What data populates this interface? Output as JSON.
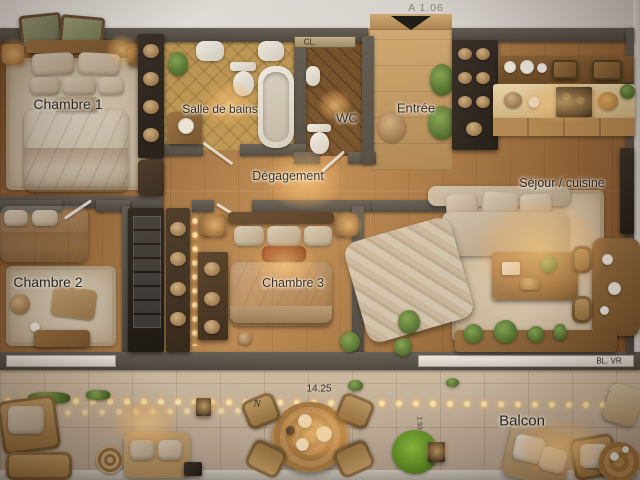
{
  "rooms": {
    "chambre1": {
      "label": "Chambre 1"
    },
    "salle_de_bains": {
      "label": "Salle de bains"
    },
    "wc": {
      "label": "WC"
    },
    "entree": {
      "label": "Entrée"
    },
    "degagement": {
      "label": "Dégagement"
    },
    "sejour_cuisine": {
      "label": "Séjour / cuisine"
    },
    "chambre2": {
      "label": "Chambre 2"
    },
    "chambre3": {
      "label": "Chambre 3"
    },
    "balcon": {
      "label": "Balcon"
    }
  },
  "annotations": {
    "entry_door_dimension": "A 1.06",
    "closet": "CL.",
    "balcony_length": "14.25",
    "balcony_depth": "1.93",
    "window_code": "BL. VR",
    "north": "N"
  },
  "colors": {
    "wall": "#55504a",
    "wood_floor": "#a2703e",
    "balcony_floor": "#cabaa7",
    "exterior": "#ddd9d2",
    "lamp_glow": "#ffcf8a",
    "accent_pillow": "#8a3c20",
    "plant": "#5d7d35",
    "fixture_white": "#f2efe8"
  }
}
